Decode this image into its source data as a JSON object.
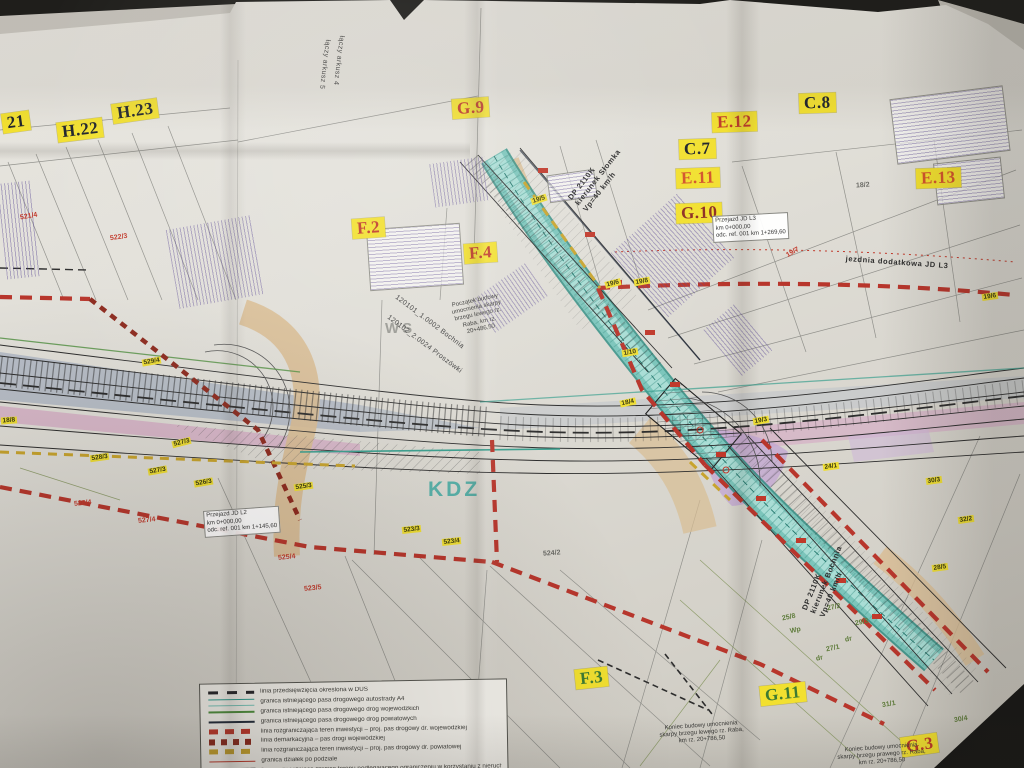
{
  "palette": {
    "sticker_yellow": "#f2e030",
    "boundary_red": "#b8362c",
    "demarcation_red": "#8e2b1f",
    "river_teal": "#7cc5bb",
    "ramp_tan": "#d9bd93",
    "carriageway_blue": "#a9b3c2",
    "median_pink": "#d6aec6"
  },
  "grid_labels": [
    {
      "text": "21",
      "x": 2,
      "y": 112,
      "rot": -8,
      "color": "dark"
    },
    {
      "text": "H.22",
      "x": 57,
      "y": 120,
      "rot": -7,
      "color": "dark"
    },
    {
      "text": "H.23",
      "x": 112,
      "y": 101,
      "rot": -8,
      "color": "dark"
    },
    {
      "text": "G.9",
      "x": 452,
      "y": 98,
      "rot": -4,
      "color": "red"
    },
    {
      "text": "E.12",
      "x": 712,
      "y": 112,
      "rot": -2,
      "color": "red"
    },
    {
      "text": "C.8",
      "x": 799,
      "y": 93,
      "rot": -2,
      "color": "dark"
    },
    {
      "text": "C.7",
      "x": 679,
      "y": 139,
      "rot": -2,
      "color": "dark"
    },
    {
      "text": "E.11",
      "x": 676,
      "y": 168,
      "rot": -2,
      "color": "orange"
    },
    {
      "text": "E.13",
      "x": 916,
      "y": 168,
      "rot": -2,
      "color": "orange"
    },
    {
      "text": "G.10",
      "x": 676,
      "y": 203,
      "rot": -2,
      "color": "darkred"
    },
    {
      "text": "F.2",
      "x": 352,
      "y": 218,
      "rot": -4,
      "color": "red"
    },
    {
      "text": "F.4",
      "x": 464,
      "y": 243,
      "rot": -4,
      "color": "red"
    },
    {
      "text": "F.3",
      "x": 575,
      "y": 668,
      "rot": -6,
      "color": "green"
    },
    {
      "text": "G.11",
      "x": 760,
      "y": 684,
      "rot": -6,
      "color": "green"
    },
    {
      "text": "G.3",
      "x": 901,
      "y": 735,
      "rot": -8,
      "color": "red"
    }
  ],
  "parcel_tags_yellow": [
    {
      "text": "19/5",
      "x": 531,
      "y": 196,
      "rot": -18
    },
    {
      "text": "19/6",
      "x": 605,
      "y": 280,
      "rot": -14
    },
    {
      "text": "19/8",
      "x": 634,
      "y": 278,
      "rot": -10
    },
    {
      "text": "1/10",
      "x": 622,
      "y": 349,
      "rot": -10
    },
    {
      "text": "18/4",
      "x": 620,
      "y": 399,
      "rot": -12
    },
    {
      "text": "19/3",
      "x": 753,
      "y": 417,
      "rot": -10
    },
    {
      "text": "19/6",
      "x": 982,
      "y": 293,
      "rot": -8
    },
    {
      "text": "24/1",
      "x": 823,
      "y": 463,
      "rot": -8
    },
    {
      "text": "30/3",
      "x": 926,
      "y": 477,
      "rot": -8
    },
    {
      "text": "32/2",
      "x": 958,
      "y": 516,
      "rot": -8
    },
    {
      "text": "28/5",
      "x": 932,
      "y": 564,
      "rot": -8
    },
    {
      "text": "18/8",
      "x": 1,
      "y": 417,
      "rot": -4
    },
    {
      "text": "529/4",
      "x": 142,
      "y": 358,
      "rot": -10
    },
    {
      "text": "527/3",
      "x": 172,
      "y": 439,
      "rot": -14
    },
    {
      "text": "528/3",
      "x": 90,
      "y": 454,
      "rot": -8
    },
    {
      "text": "527/3",
      "x": 148,
      "y": 467,
      "rot": -10
    },
    {
      "text": "526/3",
      "x": 194,
      "y": 479,
      "rot": -10
    },
    {
      "text": "525/3",
      "x": 294,
      "y": 483,
      "rot": -8
    },
    {
      "text": "523/3",
      "x": 402,
      "y": 526,
      "rot": -6
    },
    {
      "text": "523/4",
      "x": 442,
      "y": 538,
      "rot": -6
    }
  ],
  "parcel_numbers": [
    {
      "text": "521/4",
      "x": 20,
      "y": 213,
      "rot": -10,
      "color": "red"
    },
    {
      "text": "522/3",
      "x": 110,
      "y": 234,
      "rot": -8,
      "color": "red"
    },
    {
      "text": "528/4",
      "x": 74,
      "y": 500,
      "rot": -6,
      "color": "red"
    },
    {
      "text": "527/4",
      "x": 138,
      "y": 517,
      "rot": -6,
      "color": "red"
    },
    {
      "text": "525/4",
      "x": 278,
      "y": 554,
      "rot": -6,
      "color": "red"
    },
    {
      "text": "523/5",
      "x": 304,
      "y": 585,
      "rot": -6,
      "color": "red"
    },
    {
      "text": "19/7",
      "x": 786,
      "y": 249,
      "rot": -30,
      "color": "red"
    },
    {
      "text": "25/8",
      "x": 782,
      "y": 614,
      "rot": -12,
      "color": "green"
    },
    {
      "text": "Wp",
      "x": 790,
      "y": 627,
      "rot": -12,
      "color": "green"
    },
    {
      "text": "27/2",
      "x": 827,
      "y": 604,
      "rot": -12,
      "color": "green"
    },
    {
      "text": "29/3",
      "x": 855,
      "y": 619,
      "rot": -12,
      "color": "green"
    },
    {
      "text": "dr",
      "x": 845,
      "y": 636,
      "rot": -12,
      "color": "green"
    },
    {
      "text": "27/1",
      "x": 826,
      "y": 645,
      "rot": -12,
      "color": "green"
    },
    {
      "text": "dr",
      "x": 816,
      "y": 655,
      "rot": -12,
      "color": "green"
    },
    {
      "text": "31/1",
      "x": 882,
      "y": 701,
      "rot": -10,
      "color": "green"
    },
    {
      "text": "30/4",
      "x": 954,
      "y": 716,
      "rot": -10,
      "color": "green"
    },
    {
      "text": "18/2",
      "x": 856,
      "y": 182,
      "rot": -4,
      "color": "gray"
    },
    {
      "text": "524/2",
      "x": 543,
      "y": 550,
      "rot": -4,
      "color": "gray"
    }
  ],
  "road_labels": [
    {
      "lines": [
        "DP 2110K",
        "kierunek Słomka",
        "Vp=40 km/h"
      ],
      "x": 566,
      "y": 196,
      "rot": -52
    },
    {
      "lines": [
        "DP 2110K",
        "kierunek Bochnia",
        "Vp=40 km/h"
      ],
      "x": 800,
      "y": 608,
      "rot": -68
    },
    {
      "lines": [
        "jezdnia dodatkowa JD L3"
      ],
      "x": 846,
      "y": 254,
      "rot": 4
    }
  ],
  "zone_labels": [
    {
      "text": "WS",
      "x": 385,
      "y": 320,
      "rot": 0,
      "cls": "ws"
    },
    {
      "text": "KDZ",
      "x": 428,
      "y": 478,
      "rot": 0,
      "cls": "kdz"
    }
  ],
  "rotated_texts": [
    {
      "text": "120101_1.0002 Bochnia",
      "x": 398,
      "y": 294,
      "rot": 37
    },
    {
      "text": "120102_2.0024 Proszówki",
      "x": 390,
      "y": 314,
      "rot": 37
    },
    {
      "text": "łączy arkusz 4",
      "x": 345,
      "y": 36,
      "rot": 97
    },
    {
      "text": "łączy arkusz 5",
      "x": 331,
      "y": 40,
      "rot": 97
    }
  ],
  "note_boxes": [
    {
      "lines": [
        "Przejazd JD L3",
        "km 0+000,00",
        "odc. ref. 001 km 1+269,60"
      ],
      "x": 712,
      "y": 216,
      "rot": -3
    },
    {
      "lines": [
        "Przejazd JD L2",
        "km 0+000,00",
        "odc. ref. 001 km 1+145,60"
      ],
      "x": 203,
      "y": 511,
      "rot": -4
    }
  ],
  "annotations": [
    {
      "text": "Początek budowy umocnienia skarpy brzegu lewego rz. Raba, km rz. 20+486,50",
      "x": 446,
      "y": 304,
      "rot": -12,
      "w": 58
    },
    {
      "text": "Koniec budowy umocnienia skarpy brzegu lewego rz. Raba, km rz. 20+786,50",
      "x": 655,
      "y": 726,
      "rot": -4,
      "w": 92
    },
    {
      "text": "Koniec budowy umocnienia skarpy brzegu prawego rz. Raba, km rz. 20+786,50",
      "x": 835,
      "y": 748,
      "rot": -4,
      "w": 92
    }
  ],
  "legend": {
    "items": [
      {
        "swatch": "dash-black",
        "label": "linia przedsięwzięcia określona w DUŚ"
      },
      {
        "swatch": "line-teal",
        "label": "granica istniejącego pasa drogowego autostrady A4"
      },
      {
        "swatch": "line-green",
        "label": "granica istniejącego pasa drogowego dróg wojewódzkich"
      },
      {
        "swatch": "line-navy",
        "label": "granica istniejącego pasa drogowego dróg powiatowych"
      },
      {
        "swatch": "dash-red",
        "label": "linia rozgraniczająca teren inwestycji – proj. pas drogowy dr. wojewódzkiej"
      },
      {
        "swatch": "dash-darkred",
        "label": "linia demarkacyjna – pas drogi wojewódzkiej"
      },
      {
        "swatch": "dash-yellow",
        "label": "linia rozgraniczająca teren inwestycji – proj. pas drogowy dr. powiatowej"
      },
      {
        "swatch": "line-red",
        "label": "granica działek po podziale"
      },
      {
        "swatch": "bar-dark",
        "label": "linia wyznaczająca granice terenu podlegającego ograniczeniu w korzystaniu z nieruchomości"
      }
    ]
  }
}
